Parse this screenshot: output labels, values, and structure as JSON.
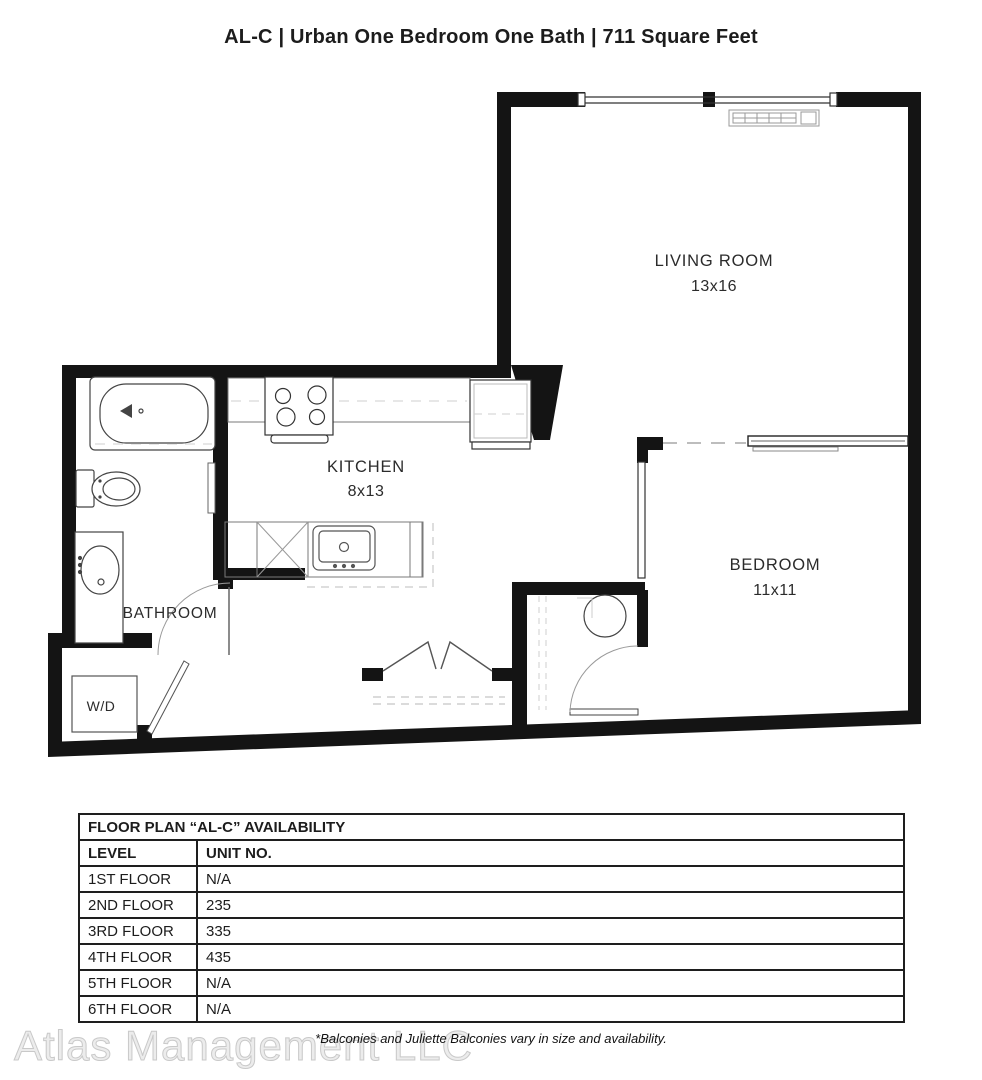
{
  "title": "AL-C | Urban One Bedroom One Bath | 711 Square Feet",
  "colors": {
    "wall": "#141414",
    "background": "#ffffff"
  },
  "floor_plan": {
    "rooms": [
      {
        "name": "LIVING ROOM",
        "dimensions": "13x16"
      },
      {
        "name": "KITCHEN",
        "dimensions": "8x13"
      },
      {
        "name": "BEDROOM",
        "dimensions": "11x11"
      },
      {
        "name": "BATHROOM",
        "dimensions": ""
      },
      {
        "name": "W/D",
        "dimensions": ""
      }
    ]
  },
  "availability_table": {
    "title": "FLOOR PLAN “AL-C” AVAILABILITY",
    "columns": [
      "LEVEL",
      "UNIT NO."
    ],
    "rows": [
      {
        "level": "1ST FLOOR",
        "unit": "N/A"
      },
      {
        "level": "2ND FLOOR",
        "unit": "235"
      },
      {
        "level": "3RD FLOOR",
        "unit": "335"
      },
      {
        "level": "4TH FLOOR",
        "unit": "435"
      },
      {
        "level": "5TH FLOOR",
        "unit": "N/A"
      },
      {
        "level": "6TH FLOOR",
        "unit": "N/A"
      }
    ]
  },
  "footer": {
    "watermark": "Atlas Management LLC",
    "note": "*Balconies and Juliette Balconies vary in size and availability."
  }
}
